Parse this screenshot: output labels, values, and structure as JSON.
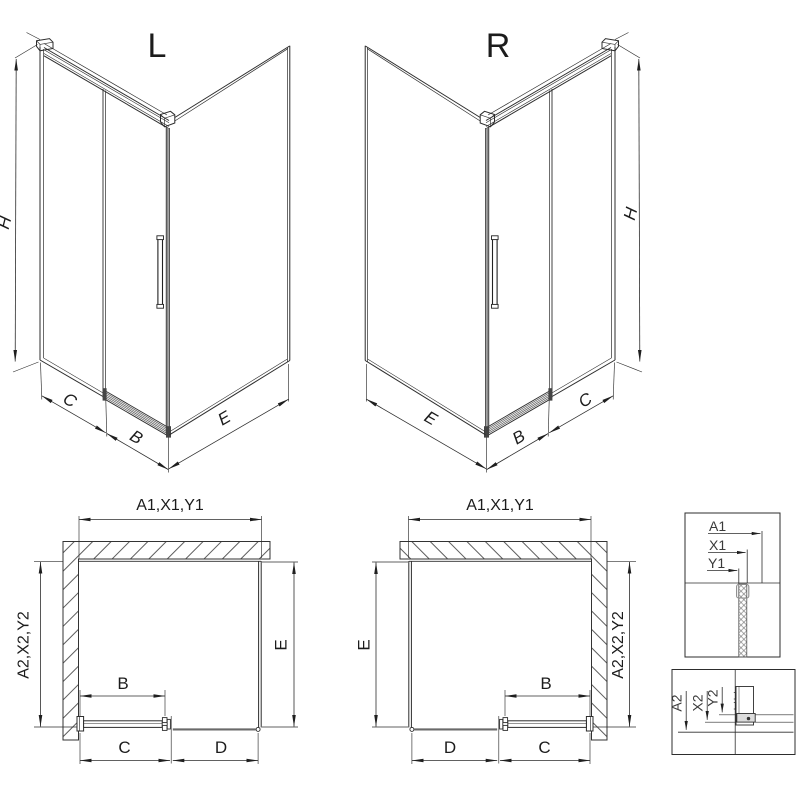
{
  "drawing": {
    "iso_left": {
      "title": "L",
      "h": "H",
      "c": "C",
      "b": "B",
      "e": "E"
    },
    "iso_right": {
      "title": "R",
      "h": "H",
      "c": "C",
      "b": "B",
      "e": "E"
    },
    "plan_left": {
      "top": "A1,X1,Y1",
      "left": "A2,X2,Y2",
      "right": "E",
      "b": "B",
      "c": "C",
      "d": "D"
    },
    "plan_right": {
      "top": "A1,X1,Y1",
      "left": "E",
      "right": "A2,X2,Y2",
      "b": "B",
      "c": "C",
      "d": "D"
    },
    "detail_top": {
      "a": "A1",
      "x": "X1",
      "y": "Y1"
    },
    "detail_bottom": {
      "a": "A2",
      "x": "X2",
      "y": "Y2"
    },
    "colors": {
      "line": "#2d2d2d",
      "profile_gray": "#8c8c8c",
      "hatch": "#4a4a4a",
      "background": "#ffffff"
    }
  }
}
